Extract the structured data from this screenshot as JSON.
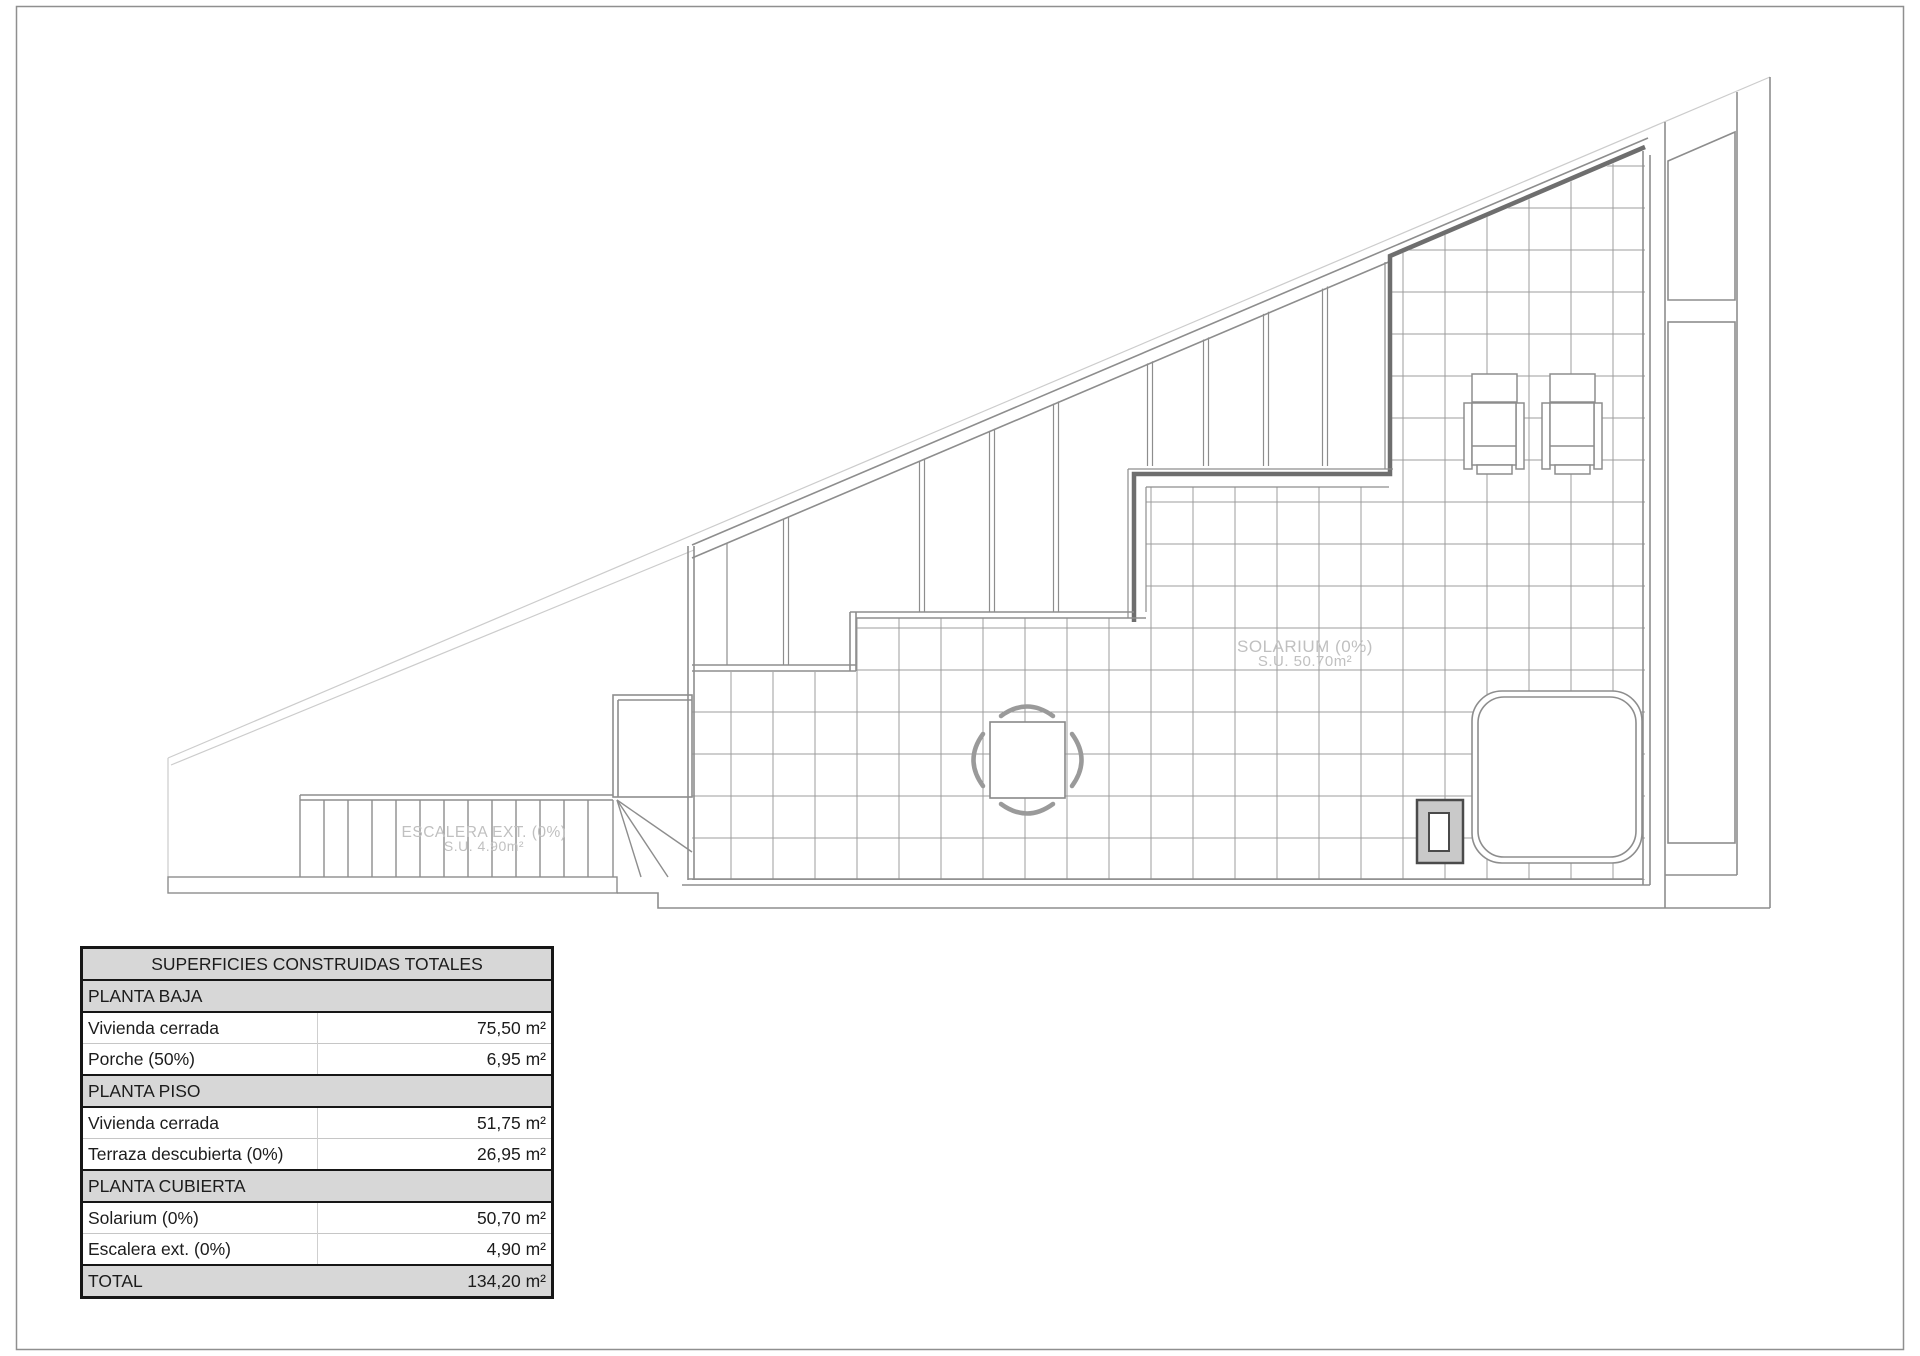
{
  "page": {
    "background": "#ffffff",
    "border_color": "#8f8f8f"
  },
  "plan": {
    "line_colors": {
      "site_boundary": "#cccccc",
      "walls": "#8d8d8d",
      "thick_wall": "#6e6e6e",
      "tile_grid": "#9c9c9c",
      "label_text": "#c0c0c0"
    },
    "solarium_label": {
      "line1": "SOLARIUM (0%)",
      "line2": "S.U. 50.70m²"
    },
    "stairs_label": {
      "line1": "ESCALERA EXT. (0%)",
      "line2": "S.U. 4.90m²"
    }
  },
  "areas_table": {
    "title": "SUPERFICIES CONSTRUIDAS TOTALES",
    "header_bg": "#d7d7d7",
    "rows": [
      {
        "type": "section",
        "label": "PLANTA BAJA",
        "value": ""
      },
      {
        "type": "item",
        "label": "Vivienda cerrada",
        "value": "75,50 m²"
      },
      {
        "type": "item",
        "label": "Porche (50%)",
        "value": "6,95 m²"
      },
      {
        "type": "section",
        "label": "PLANTA PISO",
        "value": ""
      },
      {
        "type": "item",
        "label": "Vivienda cerrada",
        "value": "51,75 m²"
      },
      {
        "type": "item",
        "label": "Terraza descubierta (0%)",
        "value": "26,95 m²"
      },
      {
        "type": "section",
        "label": "PLANTA CUBIERTA",
        "value": ""
      },
      {
        "type": "item",
        "label": "Solarium (0%)",
        "value": "50,70 m²"
      },
      {
        "type": "item",
        "label": "Escalera ext. (0%)",
        "value": "4,90 m²"
      },
      {
        "type": "total",
        "label": "TOTAL",
        "value": "134,20 m²"
      }
    ]
  }
}
